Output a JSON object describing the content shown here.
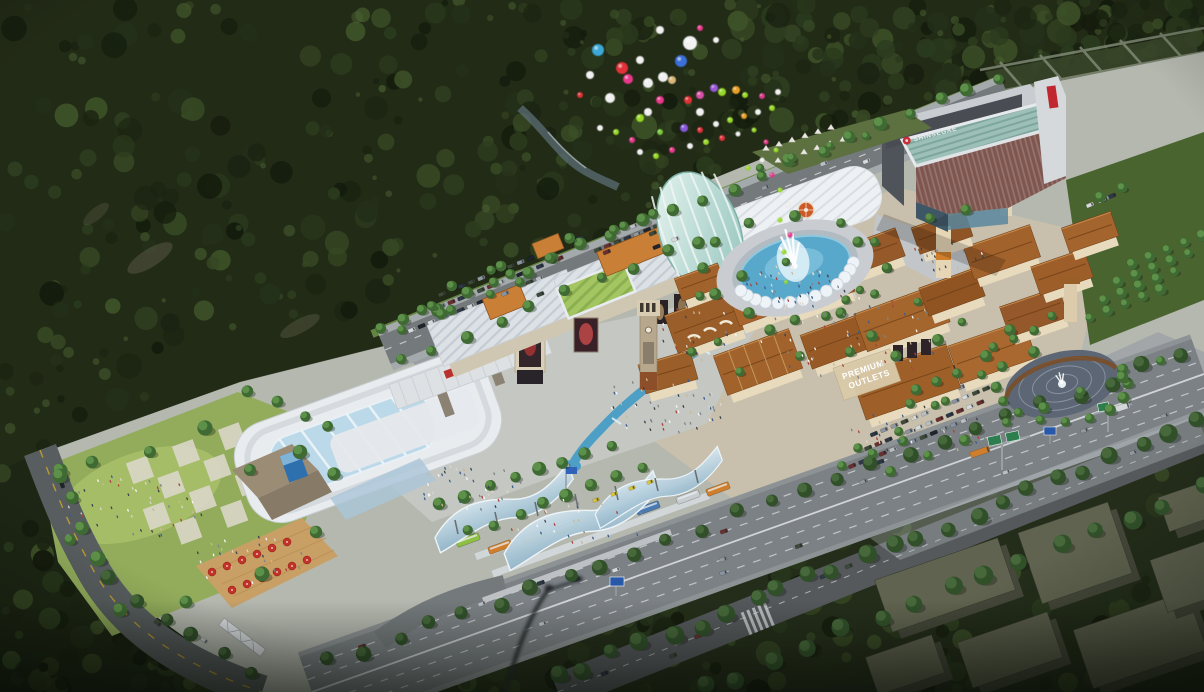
{
  "scene": {
    "type": "aerial-architectural-rendering",
    "description": "Bird's-eye 3D rendering of a Shinsegae premium outlet shopping complex nestled against forested hills: white cultural-center building and glass-atrium mall on the left, Mediterranean outlet village with terracotta roofs and clock towers on the right, central fountain plaza with scalloped canopy, large SHINSEGAE department store, glamping hill, balloons rising over the forest, bus terminal with wavy glass canopy, highways with traffic, parks and parking lots",
    "signs": {
      "department_store": "SHINSEGAE",
      "link_bridge": "SHINSEGAE",
      "outlet_wall_line1": "PREMIUM",
      "outlet_wall_line2": "OUTLETS"
    },
    "palette": {
      "forest_dark": "#1b2412",
      "forest_mid": "#2e3d1f",
      "grass": "#92ac5b",
      "pavement_light": "#c5c8c2",
      "asphalt": "#7c8185",
      "roof_white": "#dce1e6",
      "roof_terracotta": "#a2622c",
      "facade_redbrick": "#7d5650",
      "roof_teal_glass": "#9cc0b8",
      "accent_orange": "#c97f36",
      "water_blue": "#58a8cc",
      "canopy_glass_blue": "#aecde0",
      "signal_red": "#c62f36",
      "balloon_lime": "#98d828",
      "balloon_pink": "#e8388c"
    },
    "balloons": {
      "points": [
        [
          660,
          30,
          4,
          "#f0f0f0"
        ],
        [
          700,
          28,
          3,
          "#e8388c"
        ],
        [
          716,
          40,
          3,
          "#f0f0f0"
        ],
        [
          690,
          43,
          7,
          "#f2f2f2"
        ],
        [
          598,
          50,
          6,
          "#3aa8d8"
        ],
        [
          681,
          61,
          6,
          "#3a6fd8"
        ],
        [
          622,
          68,
          6,
          "#e03038"
        ],
        [
          628,
          79,
          5,
          "#e8388c"
        ],
        [
          648,
          83,
          5,
          "#f0f0f0"
        ],
        [
          663,
          77,
          5,
          "#f0f0f0"
        ],
        [
          672,
          80,
          4,
          "#d8b87a"
        ],
        [
          640,
          60,
          4,
          "#f0f0f0"
        ],
        [
          590,
          75,
          4,
          "#f0f0f0"
        ],
        [
          580,
          95,
          3,
          "#e03038"
        ],
        [
          610,
          98,
          5,
          "#f0f0f0"
        ],
        [
          660,
          100,
          4,
          "#e8388c"
        ],
        [
          688,
          100,
          4,
          "#e03038"
        ],
        [
          700,
          95,
          4,
          "#d84fa8"
        ],
        [
          648,
          112,
          4,
          "#f0f0f0"
        ],
        [
          640,
          118,
          4,
          "#98d828"
        ],
        [
          700,
          112,
          4,
          "#f0f0f0"
        ],
        [
          714,
          88,
          4,
          "#9a58d8"
        ],
        [
          722,
          92,
          4,
          "#98d828"
        ],
        [
          736,
          90,
          4,
          "#e8a028"
        ],
        [
          745,
          95,
          3,
          "#98d828"
        ],
        [
          600,
          128,
          3,
          "#f0f0f0"
        ],
        [
          616,
          132,
          3,
          "#98d828"
        ],
        [
          632,
          140,
          3,
          "#e8388c"
        ],
        [
          660,
          132,
          3,
          "#78c838"
        ],
        [
          684,
          128,
          4,
          "#8858d8"
        ],
        [
          700,
          130,
          3,
          "#e03038"
        ],
        [
          716,
          124,
          3,
          "#f0f0f0"
        ],
        [
          730,
          120,
          3,
          "#98d828"
        ],
        [
          744,
          116,
          3,
          "#e8a028"
        ],
        [
          758,
          112,
          3,
          "#f0f0f0"
        ],
        [
          772,
          108,
          3,
          "#98d828"
        ],
        [
          762,
          96,
          3,
          "#d8388c"
        ],
        [
          778,
          92,
          3,
          "#f0f0f0"
        ],
        [
          640,
          152,
          3,
          "#f0f0f0"
        ],
        [
          656,
          156,
          3,
          "#98d828"
        ],
        [
          672,
          150,
          3,
          "#e8388c"
        ],
        [
          690,
          146,
          3,
          "#f0f0f0"
        ],
        [
          706,
          142,
          3,
          "#98d828"
        ],
        [
          722,
          138,
          3,
          "#e03038"
        ],
        [
          738,
          134,
          2.5,
          "#f0f0f0"
        ],
        [
          754,
          130,
          2.5,
          "#98d828"
        ],
        [
          766,
          142,
          2.5,
          "#e8388c"
        ],
        [
          776,
          150,
          2.5,
          "#98d828"
        ],
        [
          762,
          160,
          2.5,
          "#f0f0f0"
        ],
        [
          748,
          168,
          2.5,
          "#98d828"
        ],
        [
          772,
          175,
          2.5,
          "#e8388c"
        ],
        [
          780,
          190,
          2.5,
          "#98d828"
        ],
        [
          788,
          205,
          2.5,
          "#f0f0f0"
        ],
        [
          780,
          220,
          2.5,
          "#98d828"
        ],
        [
          790,
          235,
          2.5,
          "#e8388c"
        ],
        [
          784,
          252,
          2.5,
          "#98d828"
        ],
        [
          792,
          268,
          2,
          "#f0f0f0"
        ],
        [
          786,
          282,
          2,
          "#98d828"
        ]
      ]
    }
  }
}
